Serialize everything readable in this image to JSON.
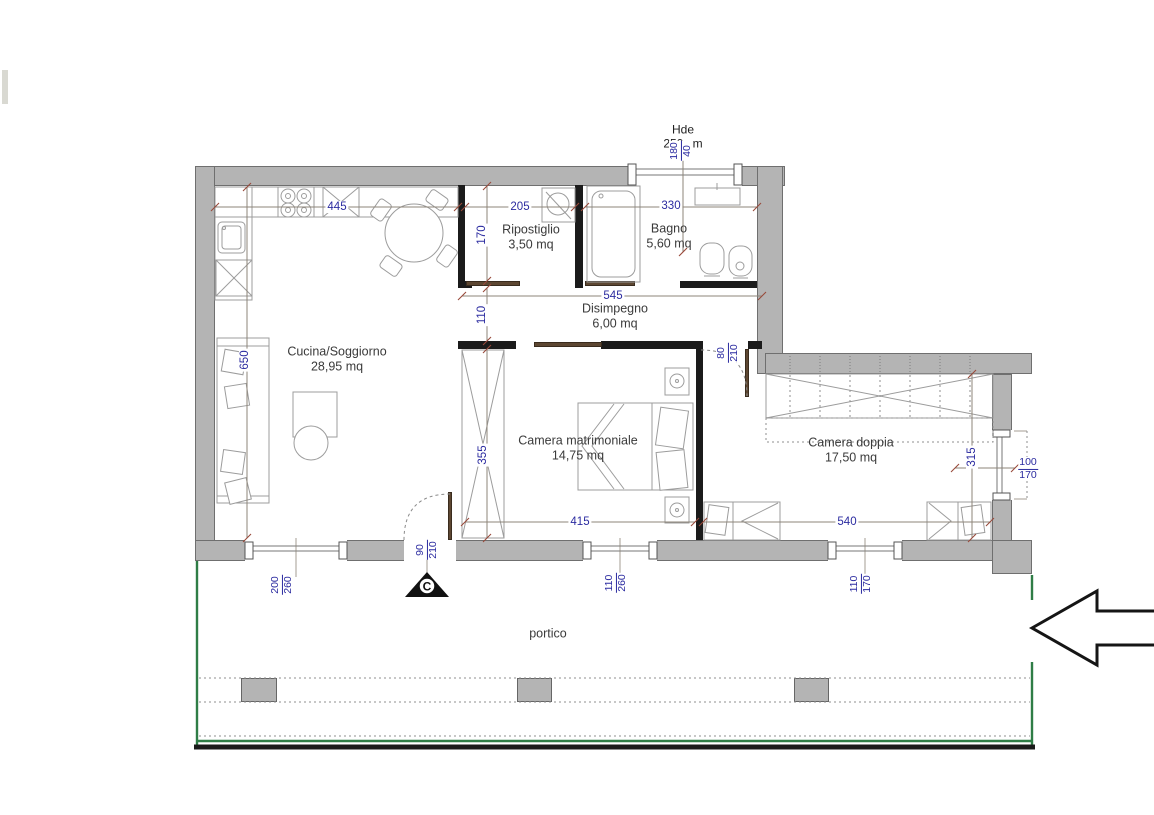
{
  "rooms": {
    "cucina": {
      "name": "Cucina/Soggiorno",
      "area": "28,95 mq"
    },
    "ripostiglio": {
      "name": "Ripostiglio",
      "area": "3,50 mq"
    },
    "bagno": {
      "name": "Bagno",
      "area": "5,60 mq"
    },
    "disimpegno": {
      "name": "Disimpegno",
      "area": "6,00 mq"
    },
    "camera_matrimoniale": {
      "name": "Camera matrimoniale",
      "area": "14,75 mq"
    },
    "camera_doppia": {
      "name": "Camera doppia",
      "area": "17,50 mq"
    },
    "portico": {
      "name": "portico"
    }
  },
  "dimensions": {
    "cucina_width": "445",
    "ripostiglio_width": "205",
    "bagno_width": "330",
    "ripostiglio_depth": "170",
    "disimpegno_depth": "110",
    "disimpegno_width": "545",
    "cucina_depth": "650",
    "matrimoniale_depth": "355",
    "matrimoniale_width": "415",
    "doppia_width": "540",
    "doppia_depth": "315"
  },
  "openings": {
    "top_window": {
      "w": "180",
      "h": "40"
    },
    "entrance_door": {
      "w": "90",
      "h": "210"
    },
    "window_left": {
      "w": "200",
      "h": "260"
    },
    "window_center": {
      "w": "110",
      "h": "260"
    },
    "window_right": {
      "w": "110",
      "h": "170"
    },
    "door_doppia": {
      "w": "80",
      "h": "210"
    },
    "window_east": {
      "w": "100",
      "h": "170"
    }
  },
  "annotations": {
    "height_note": {
      "line1": "Hde",
      "line2": "250 cm"
    },
    "section_marker": "C"
  },
  "colors": {
    "wall": "#b4b4b4",
    "partition": "#1b1b1b",
    "dimension_text": "#2b2ba0",
    "door": "#5d4732",
    "portico_line": "#2f7d46"
  }
}
